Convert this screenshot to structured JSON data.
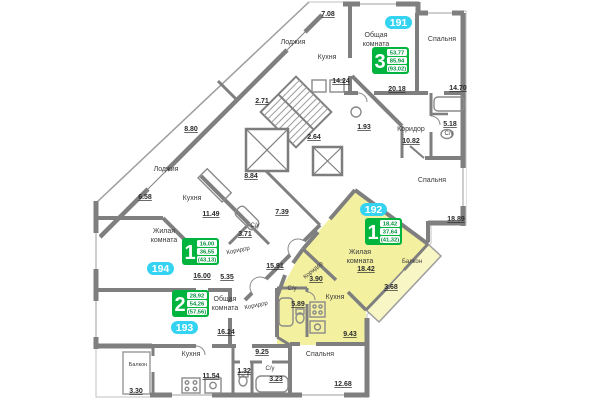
{
  "plan_title": "Типовой этаж — квартиры 191–194",
  "colors": {
    "wall": "#7f7f7f",
    "highlight_flat": "#f3f0a0",
    "highlight_balcony": "#f8f6c4",
    "badge_cyan": "#35d3f2",
    "info_green": "#00b43e",
    "value_green": "#00913c"
  },
  "apts": [
    {
      "id": "191",
      "rooms": "3",
      "living": "53,77",
      "total": "85,94",
      "full": "(93,02)"
    },
    {
      "id": "192",
      "rooms": "1",
      "living": "18,42",
      "total": "37,64",
      "full": "(41,32)"
    },
    {
      "id": "193",
      "rooms": "2",
      "living": "28,92",
      "total": "54,26",
      "full": "(57,56)"
    },
    {
      "id": "194",
      "rooms": "1",
      "living": "16,00",
      "total": "36,55",
      "full": "(43,13)"
    }
  ],
  "words": {
    "obshaya": "Общая",
    "komnata": "комната",
    "zhilaya": "Жилая",
    "kuhnya": "Кухня",
    "spalnya": "Спальня",
    "koridor": "Коридор",
    "lodzhiya": "Лоджия",
    "balkon": "Балкон",
    "su": "С/у"
  },
  "areas": {
    "a191_common": "20.18",
    "a191_sp1": "14.70",
    "a191_kitchen": "14.24",
    "a191_su": "5.18",
    "a191_cor": "10.82",
    "a191_sp2": "18.89",
    "a191_lodzh": "7.08",
    "a194_living": "16.00",
    "a194_kitchen": "11.49",
    "a194_su": "3.71",
    "a194_cor": "5.35",
    "a194_lodzh": "6.58",
    "a193_common": "16.24",
    "a193_sp": "12.68",
    "a193_kitchen": "11.54",
    "a193_cor": "9.25",
    "a193_su1": "1.32",
    "a193_su2": "3.23",
    "a193_balkon": "3.30",
    "a192_living": "18.42",
    "a192_kitchen": "9.43",
    "a192_su": "5.89",
    "a192_cor": "3.90",
    "a192_balkon": "3.68",
    "c_cor": "15.91",
    "c_739": "7.39",
    "c_880": "8.80",
    "c_884": "8.84",
    "c_271": "2.71",
    "c_264": "2.64",
    "c_193room": "1.93"
  }
}
